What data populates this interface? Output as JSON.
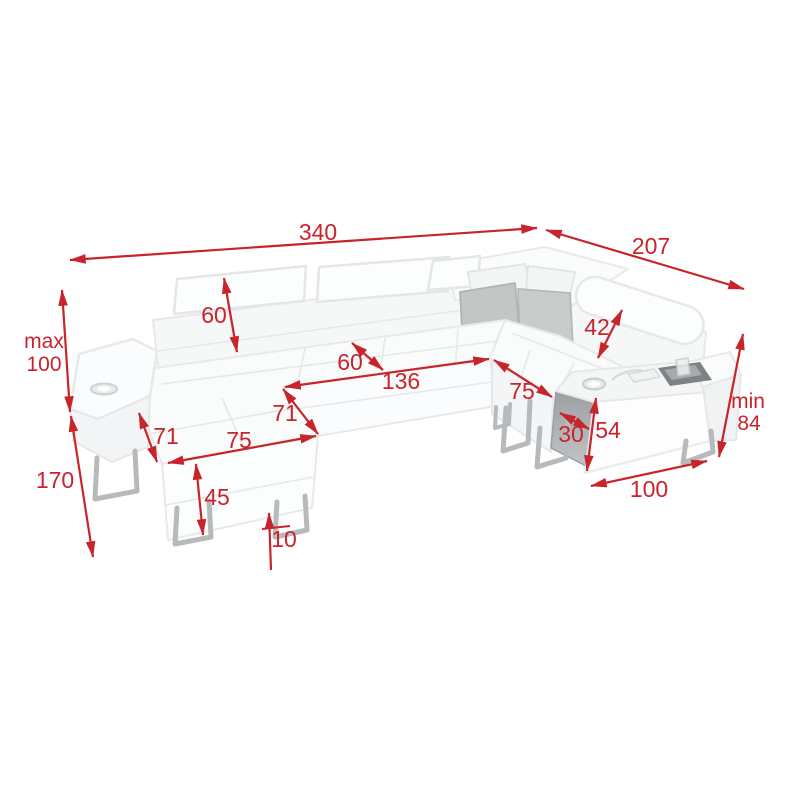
{
  "page": {
    "type": "product-dimension-diagram",
    "subject": "u-shaped-corner-sofa",
    "background": "#ffffff"
  },
  "colors": {
    "dimension_red": "#c8242b",
    "sofa_body": "#fbfcfd",
    "sofa_shade": "#f0f2f3",
    "pillow_left": "#c3c6c5",
    "pillow_right": "#c9cccb",
    "console_panel": "#aaadb0",
    "tray_dark": "#7e8185",
    "legs_metal": "#b7babc"
  },
  "dimensions": {
    "total_width": {
      "value": "340"
    },
    "depth_right": {
      "value": "207"
    },
    "height_max": {
      "prefix": "max",
      "value": "100"
    },
    "depth_left_chaise": {
      "value": "170"
    },
    "backrest_height": {
      "value": "60"
    },
    "seat_cushion_depth": {
      "value": "60"
    },
    "front_seat_length": {
      "value": "136"
    },
    "right_headrest_height": {
      "value": "42"
    },
    "right_seat_width": {
      "value": "75"
    },
    "corner_edge_depth": {
      "value": "71"
    },
    "chaise_side_depth": {
      "value": "71"
    },
    "chaise_front_width": {
      "value": "75"
    },
    "chaise_front_height": {
      "value": "45"
    },
    "leg_height": {
      "value": "10"
    },
    "console_depth": {
      "value": "30"
    },
    "console_height": {
      "value": "54"
    },
    "height_min": {
      "prefix": "min",
      "value": "84"
    },
    "right_section_length": {
      "value": "100"
    }
  }
}
